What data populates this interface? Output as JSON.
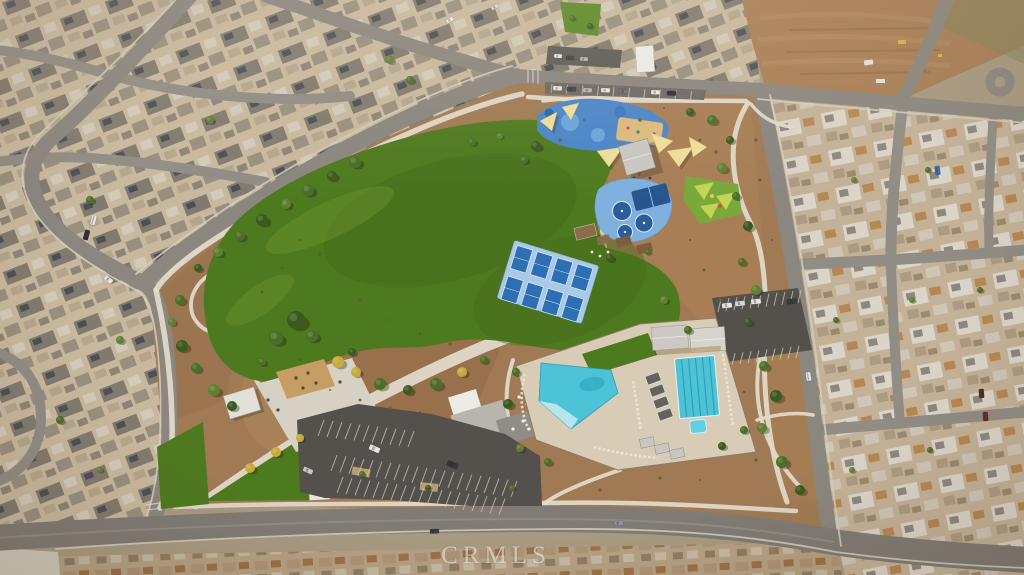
{
  "watermark": {
    "text": "CRMLS"
  },
  "colors": {
    "base": "#a89a80",
    "housesNW": "#c8b89e",
    "housesE": "#c4b298",
    "housesS": "#b5a083",
    "dirtLot": "#a87e55",
    "parkDirt": "#a07a54",
    "road": "#8b867e",
    "roadMinor": "#918c84",
    "roadBottom": "#807b74",
    "sidewalk": "#d4cec0",
    "path": "#e0d9c9",
    "concrete": "#d7d1c3",
    "dg": "#c69d63",
    "lawn": "#4e7a1f",
    "lawnDark": "#44691b",
    "lawnLight": "#739733",
    "asphalt": "#54514d",
    "stall": "#cfc9bb",
    "playBlue": "#4b86c8",
    "bballPad": "#7fb0de",
    "courtNavy": "#2a5d9c",
    "pickleballPad": "#a9c9e8",
    "pickleballCourt": "#2e6fb4",
    "poolWater": "#4cc3d6",
    "deck": "#d9ccb6",
    "sailYellow": "#eedd9b",
    "sailLime": "#c3d558",
    "totGreen": "#7aa83b",
    "sand": "#dcba80",
    "roofWhite": "#ecebe6",
    "roofGray": "#b8b5af",
    "roofDarkGray": "#908d87"
  },
  "scene": {
    "tree_colors": [
      "#3a5a20",
      "#4c6e28",
      "#5f8031",
      "#74943e",
      "#c9a93e",
      "#90a04c"
    ],
    "shrub_colors": [
      "#5c5434",
      "#4f5e2a",
      "#6b5a3a"
    ],
    "trees": [
      [
        355,
        162,
        6,
        1
      ],
      [
        332,
        176,
        5,
        0
      ],
      [
        308,
        190,
        6,
        1
      ],
      [
        286,
        204,
        5,
        2
      ],
      [
        262,
        220,
        6,
        0
      ],
      [
        240,
        236,
        5,
        1
      ],
      [
        218,
        252,
        5,
        2
      ],
      [
        198,
        268,
        4,
        0
      ],
      [
        180,
        300,
        5,
        1
      ],
      [
        172,
        322,
        4,
        2
      ],
      [
        182,
        346,
        6,
        0
      ],
      [
        196,
        368,
        5,
        1
      ],
      [
        214,
        390,
        6,
        2
      ],
      [
        232,
        406,
        5,
        0
      ],
      [
        296,
        320,
        9,
        0
      ],
      [
        276,
        338,
        7,
        1
      ],
      [
        312,
        336,
        6,
        1
      ],
      [
        338,
        362,
        6,
        4
      ],
      [
        356,
        372,
        5,
        4
      ],
      [
        380,
        384,
        6,
        1
      ],
      [
        408,
        390,
        5,
        0
      ],
      [
        436,
        384,
        6,
        1
      ],
      [
        462,
        372,
        5,
        4
      ],
      [
        484,
        360,
        4,
        1
      ],
      [
        250,
        468,
        5,
        4
      ],
      [
        276,
        452,
        5,
        4
      ],
      [
        300,
        438,
        4,
        4
      ],
      [
        262,
        362,
        4,
        1
      ],
      [
        352,
        352,
        4,
        0
      ],
      [
        536,
        146,
        5,
        0
      ],
      [
        524,
        160,
        4,
        1
      ],
      [
        472,
        142,
        4,
        1
      ],
      [
        500,
        136,
        3,
        2
      ],
      [
        690,
        112,
        4,
        0
      ],
      [
        712,
        120,
        5,
        1
      ],
      [
        730,
        140,
        4,
        0
      ],
      [
        722,
        168,
        5,
        2
      ],
      [
        736,
        196,
        4,
        1
      ],
      [
        748,
        226,
        5,
        0
      ],
      [
        742,
        262,
        4,
        1
      ],
      [
        756,
        290,
        5,
        2
      ],
      [
        748,
        322,
        4,
        0
      ],
      [
        764,
        366,
        5,
        1
      ],
      [
        776,
        396,
        6,
        0
      ],
      [
        762,
        428,
        5,
        2
      ],
      [
        782,
        462,
        6,
        1
      ],
      [
        800,
        490,
        5,
        0
      ],
      [
        516,
        372,
        4,
        1
      ],
      [
        508,
        404,
        5,
        0
      ],
      [
        520,
        448,
        4,
        2
      ],
      [
        548,
        462,
        4,
        1
      ],
      [
        722,
        446,
        4,
        0
      ],
      [
        744,
        430,
        4,
        1
      ],
      [
        664,
        300,
        4,
        2
      ],
      [
        688,
        330,
        4,
        1
      ],
      [
        610,
        258,
        4,
        0
      ],
      [
        648,
        252,
        3,
        1
      ],
      [
        362,
        474,
        3,
        1
      ],
      [
        428,
        488,
        3,
        0
      ],
      [
        512,
        488,
        3,
        1
      ],
      [
        572,
        18,
        3,
        1
      ],
      [
        590,
        26,
        3,
        0
      ],
      [
        854,
        180,
        3,
        2
      ],
      [
        928,
        170,
        3,
        1
      ],
      [
        836,
        320,
        3,
        1
      ],
      [
        912,
        300,
        3,
        2
      ],
      [
        980,
        290,
        3,
        1
      ],
      [
        852,
        470,
        3,
        2
      ],
      [
        930,
        450,
        3,
        1
      ],
      [
        390,
        60,
        4,
        2
      ],
      [
        410,
        80,
        4,
        1
      ],
      [
        210,
        120,
        4,
        2
      ],
      [
        90,
        200,
        4,
        1
      ],
      [
        120,
        340,
        4,
        2
      ],
      [
        60,
        420,
        4,
        1
      ],
      [
        100,
        470,
        3,
        2
      ]
    ],
    "shrubs": [
      [
        300,
        240
      ],
      [
        320,
        254
      ],
      [
        340,
        268
      ],
      [
        282,
        268
      ],
      [
        262,
        292
      ],
      [
        360,
        300
      ],
      [
        390,
        320
      ],
      [
        420,
        334
      ],
      [
        450,
        344
      ],
      [
        330,
        390
      ],
      [
        360,
        400
      ],
      [
        390,
        408
      ],
      [
        420,
        412
      ],
      [
        300,
        360
      ],
      [
        640,
        120
      ],
      [
        664,
        108
      ],
      [
        700,
        140
      ],
      [
        716,
        152
      ],
      [
        690,
        240
      ],
      [
        704,
        270
      ],
      [
        720,
        300
      ],
      [
        736,
        360
      ],
      [
        744,
        392
      ],
      [
        756,
        460
      ],
      [
        700,
        480
      ],
      [
        660,
        478
      ],
      [
        600,
        490
      ],
      [
        360,
        448
      ],
      [
        420,
        466
      ],
      [
        560,
        140
      ],
      [
        584,
        120
      ],
      [
        760,
        180
      ],
      [
        756,
        140
      ],
      [
        772,
        240
      ]
    ],
    "cars": [
      [
        553,
        86,
        9,
        4.5,
        3,
        "#e9e7e1"
      ],
      [
        567,
        87,
        9,
        4.5,
        3,
        "#3f434a"
      ],
      [
        583,
        88,
        9,
        4.5,
        3,
        "#b9b7b2"
      ],
      [
        601,
        88,
        9,
        4.5,
        3,
        "#e9e7e1"
      ],
      [
        619,
        89,
        9,
        4.5,
        3,
        "#6d727a"
      ],
      [
        651,
        90,
        9,
        4.5,
        3,
        "#e9e7e1"
      ],
      [
        667,
        91,
        9,
        4.5,
        3,
        "#2e3138"
      ],
      [
        554,
        54,
        8,
        4,
        3,
        "#e9e7e1"
      ],
      [
        566,
        56,
        8,
        4,
        3,
        "#44474c"
      ],
      [
        580,
        57,
        8,
        4,
        3,
        "#b9b7b2"
      ],
      [
        722,
        303,
        10,
        5,
        -6,
        "#e9e7e1"
      ],
      [
        735,
        301,
        10,
        5,
        -6,
        "#d8d6d0"
      ],
      [
        751,
        299,
        10,
        5,
        -6,
        "#e9e7e1"
      ],
      [
        787,
        299,
        10,
        5,
        -6,
        "#3a3d42"
      ],
      [
        369,
        446,
        11,
        5.5,
        24,
        "#e9e7e1"
      ],
      [
        447,
        462,
        11,
        5.5,
        24,
        "#33363b"
      ],
      [
        303,
        468,
        10,
        5,
        24,
        "#c9c7c1"
      ],
      [
        84,
        230,
        5,
        10,
        15,
        "#2f3237"
      ],
      [
        91,
        215,
        5,
        10,
        15,
        "#e9e7e1"
      ],
      [
        104,
        277,
        9,
        5,
        38,
        "#e9e7e1"
      ],
      [
        430,
        529,
        9,
        4.5,
        -2,
        "#3a3d42"
      ],
      [
        614,
        521,
        9,
        4.5,
        -2,
        "#90949a"
      ],
      [
        935,
        166,
        5,
        9,
        -8,
        "#3a6fb0"
      ],
      [
        979,
        389,
        5,
        9,
        -4,
        "#542e2a"
      ],
      [
        983,
        412,
        5,
        9,
        -4,
        "#6b2f28"
      ],
      [
        446,
        18,
        8,
        4,
        -28,
        "#e9e7e1"
      ],
      [
        491,
        5,
        8,
        4,
        -25,
        "#d8d6d0"
      ],
      [
        806,
        372,
        5,
        9,
        -8,
        "#e9e7e1"
      ]
    ],
    "parking_rows": [
      {
        "x": 318,
        "y": 436,
        "dx": 9,
        "dy": 1.1,
        "n": 11,
        "lx": 6,
        "ly": -16
      },
      {
        "x": 331,
        "y": 471,
        "dx": 9,
        "dy": 1.3,
        "n": 21,
        "lx": 6,
        "ly": -16
      },
      {
        "x": 343,
        "y": 477,
        "dx": 9,
        "dy": 1.2,
        "n": 19,
        "lx": -6,
        "ly": 16
      },
      {
        "x": 718,
        "y": 312,
        "dx": 8,
        "dy": -0.9,
        "n": 11,
        "lx": 3,
        "ly": -13
      },
      {
        "x": 727,
        "y": 354,
        "dx": 8,
        "dy": -0.9,
        "n": 10,
        "lx": -3,
        "ly": 12
      },
      {
        "x": 551,
        "y": 93,
        "dx": 15.5,
        "dy": 0.8,
        "n": 10,
        "lx": 1,
        "ly": -9
      }
    ]
  }
}
